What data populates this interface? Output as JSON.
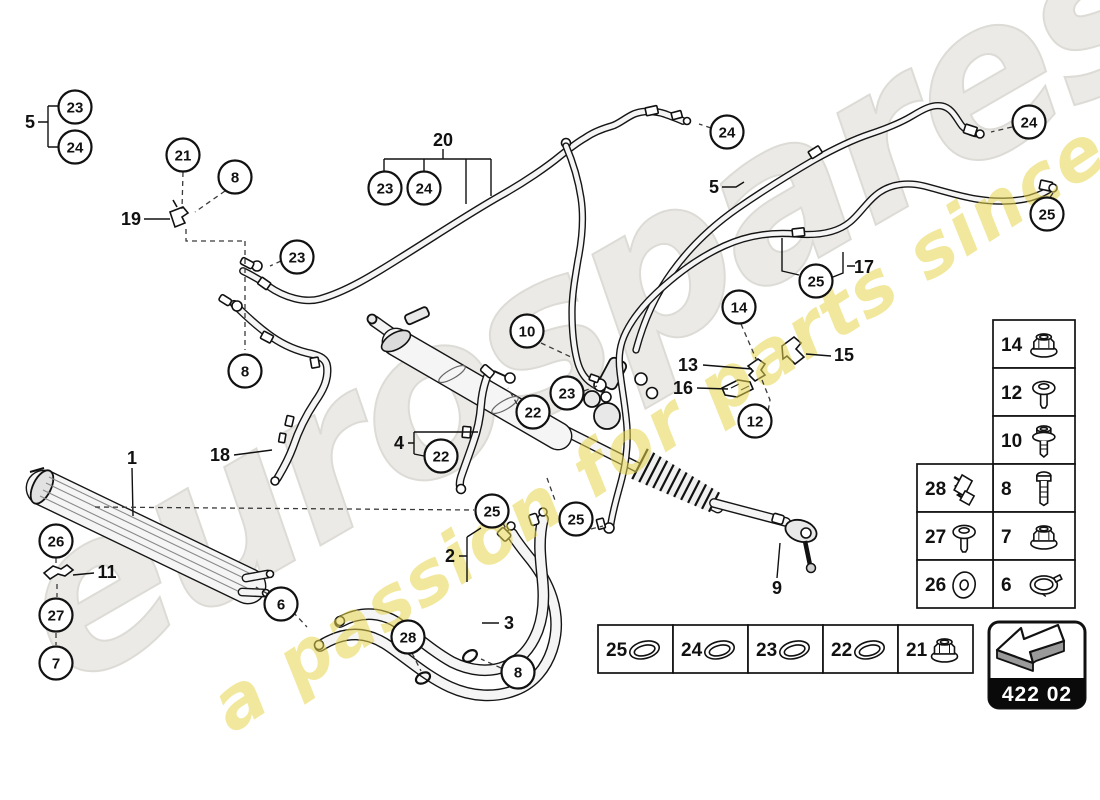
{
  "watermark": {
    "brand": "eurospares",
    "tagline": "a passion for parts since 1985"
  },
  "part_code": "422 02",
  "callouts": [
    {
      "label": "23",
      "x": 75,
      "y": 107
    },
    {
      "label": "24",
      "x": 75,
      "y": 147
    },
    {
      "label": "21",
      "x": 183,
      "y": 155
    },
    {
      "label": "8",
      "x": 235,
      "y": 177
    },
    {
      "label": "23",
      "x": 385,
      "y": 188
    },
    {
      "label": "24",
      "x": 424,
      "y": 188
    },
    {
      "label": "24",
      "x": 727,
      "y": 132
    },
    {
      "label": "24",
      "x": 1029,
      "y": 122
    },
    {
      "label": "25",
      "x": 1047,
      "y": 214
    },
    {
      "label": "23",
      "x": 297,
      "y": 257
    },
    {
      "label": "25",
      "x": 816,
      "y": 281
    },
    {
      "label": "14",
      "x": 739,
      "y": 307
    },
    {
      "label": "8",
      "x": 245,
      "y": 371
    },
    {
      "label": "10",
      "x": 527,
      "y": 331
    },
    {
      "label": "23",
      "x": 567,
      "y": 393
    },
    {
      "label": "22",
      "x": 533,
      "y": 412
    },
    {
      "label": "22",
      "x": 441,
      "y": 456
    },
    {
      "label": "12",
      "x": 755,
      "y": 421
    },
    {
      "label": "25",
      "x": 492,
      "y": 511
    },
    {
      "label": "25",
      "x": 576,
      "y": 519
    },
    {
      "label": "26",
      "x": 56,
      "y": 541
    },
    {
      "label": "27",
      "x": 56,
      "y": 615
    },
    {
      "label": "7",
      "x": 56,
      "y": 663
    },
    {
      "label": "6",
      "x": 281,
      "y": 604
    },
    {
      "label": "28",
      "x": 408,
      "y": 637
    },
    {
      "label": "8",
      "x": 518,
      "y": 672
    }
  ],
  "labels": [
    {
      "text": "5",
      "x": 30,
      "y": 128
    },
    {
      "text": "19",
      "x": 131,
      "y": 225
    },
    {
      "text": "20",
      "x": 443,
      "y": 146
    },
    {
      "text": "5",
      "x": 714,
      "y": 193
    },
    {
      "text": "17",
      "x": 864,
      "y": 273
    },
    {
      "text": "15",
      "x": 844,
      "y": 361
    },
    {
      "text": "13",
      "x": 688,
      "y": 371
    },
    {
      "text": "16",
      "x": 683,
      "y": 394
    },
    {
      "text": "18",
      "x": 220,
      "y": 461
    },
    {
      "text": "1",
      "x": 132,
      "y": 464
    },
    {
      "text": "4",
      "x": 399,
      "y": 449
    },
    {
      "text": "11",
      "x": 107,
      "y": 578
    },
    {
      "text": "2",
      "x": 450,
      "y": 562
    },
    {
      "text": "3",
      "x": 509,
      "y": 629
    },
    {
      "text": "9",
      "x": 777,
      "y": 594
    }
  ],
  "fastener_table": {
    "right_column": [
      {
        "number": "14",
        "icon": "flange-nut-icon"
      },
      {
        "number": "12",
        "icon": "torx-screw-icon"
      },
      {
        "number": "10",
        "icon": "flange-bolt-icon"
      },
      {
        "number": "8",
        "icon": "long-bolt-icon"
      },
      {
        "number": "7",
        "icon": "flange-nut-icon"
      },
      {
        "number": "6",
        "icon": "clamp-icon"
      }
    ],
    "left_column": [
      {
        "number": "28",
        "icon": "spring-clip-icon"
      },
      {
        "number": "27",
        "icon": "torx-screw-icon"
      },
      {
        "number": "26",
        "icon": "washer-icon"
      }
    ]
  },
  "seal_table": [
    {
      "number": "25",
      "icon": "o-ring-icon"
    },
    {
      "number": "24",
      "icon": "o-ring-icon"
    },
    {
      "number": "23",
      "icon": "o-ring-icon"
    },
    {
      "number": "22",
      "icon": "o-ring-icon"
    },
    {
      "number": "21",
      "icon": "flange-nut-icon"
    }
  ]
}
